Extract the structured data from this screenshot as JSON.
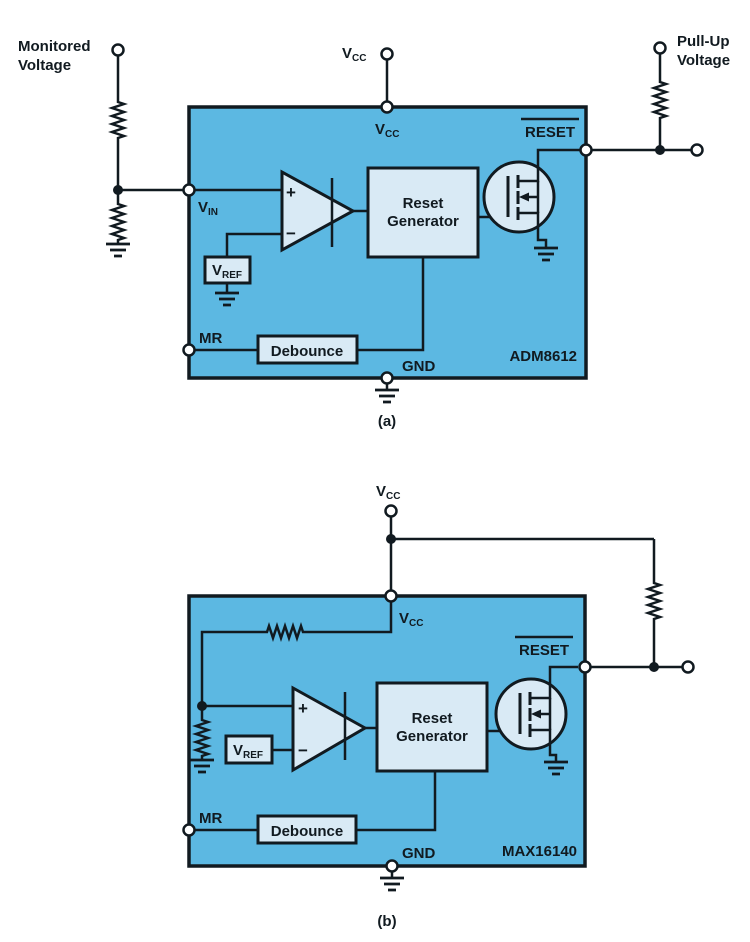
{
  "colors": {
    "bg": "#ffffff",
    "ic_fill": "#5cb8e2",
    "box_fill": "#d9eaf5",
    "ink": "#111a20"
  },
  "diagram_a": {
    "caption": "(a)",
    "part_number": "ADM8612",
    "external": {
      "monitored_line1": "Monitored",
      "monitored_line2": "Voltage",
      "vcc_v": "V",
      "vcc_sub": "CC",
      "pullup_line1": "Pull-Up",
      "pullup_line2": "Voltage"
    },
    "pins": {
      "vcc_v": "V",
      "vcc_sub": "CC",
      "vin_v": "V",
      "vin_sub": "IN",
      "mr": "MR",
      "gnd": "GND",
      "reset": "RESET"
    },
    "blocks": {
      "reset_gen_line1": "Reset",
      "reset_gen_line2": "Generator",
      "debounce": "Debounce",
      "vref_v": "V",
      "vref_sub": "REF",
      "plus": "+",
      "minus": "−"
    }
  },
  "diagram_b": {
    "caption": "(b)",
    "part_number": "MAX16140",
    "external": {
      "vcc_v": "V",
      "vcc_sub": "CC"
    },
    "pins": {
      "vcc_v": "V",
      "vcc_sub": "CC",
      "mr": "MR",
      "gnd": "GND",
      "reset": "RESET"
    },
    "blocks": {
      "reset_gen_line1": "Reset",
      "reset_gen_line2": "Generator",
      "debounce": "Debounce",
      "vref_v": "V",
      "vref_sub": "REF",
      "plus": "+",
      "minus": "−"
    }
  }
}
